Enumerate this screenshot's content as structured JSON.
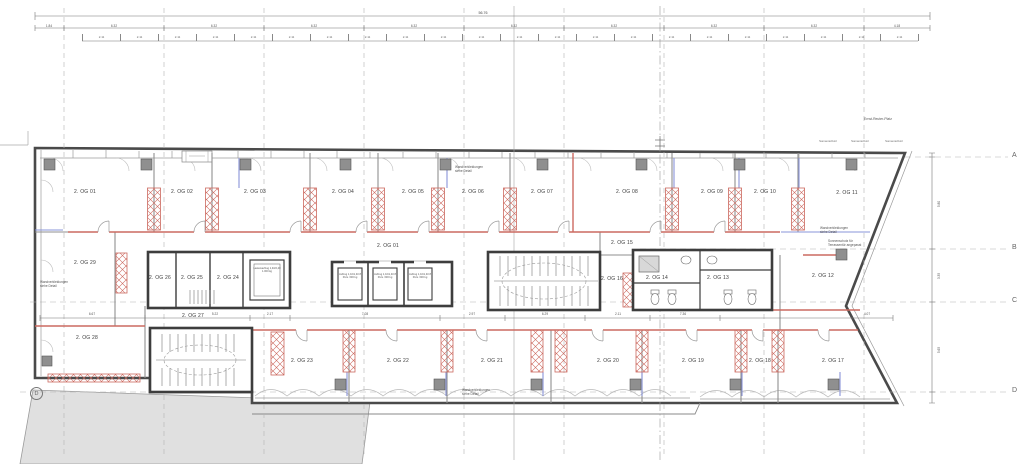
{
  "meta": {
    "drawing": "Grundriss 2. Obergeschoss",
    "floor_prefix": "2. OG"
  },
  "street_label": "Ernst-Reuter-Platz",
  "rooms": [
    {
      "label": "2. OG 01"
    },
    {
      "label": "2. OG 02"
    },
    {
      "label": "2. OG 03"
    },
    {
      "label": "2. OG 04"
    },
    {
      "label": "2. OG 05"
    },
    {
      "label": "2. OG 06"
    },
    {
      "label": "2. OG 07"
    },
    {
      "label": "2. OG 08"
    },
    {
      "label": "2. OG 09"
    },
    {
      "label": "2. OG 10"
    },
    {
      "label": "2. OG 11"
    },
    {
      "label": "2. OG 01"
    },
    {
      "label": "2. OG 15"
    },
    {
      "label": "2. OG 29"
    },
    {
      "label": "2. OG 26"
    },
    {
      "label": "2. OG 25"
    },
    {
      "label": "2. OG 24"
    },
    {
      "label": "2. OG 14"
    },
    {
      "label": "2. OG 13"
    },
    {
      "label": "2. OG 16"
    },
    {
      "label": "2. OG 12"
    },
    {
      "label": "2. OG 27"
    },
    {
      "label": "2. OG 28"
    },
    {
      "label": "2. OG 23"
    },
    {
      "label": "2. OG 22"
    },
    {
      "label": "2. OG 21"
    },
    {
      "label": "2. OG 20"
    },
    {
      "label": "2. OG 19"
    },
    {
      "label": "2. OG 18"
    },
    {
      "label": "2. OG 17"
    }
  ],
  "grid": {
    "letters": [
      "A",
      "B",
      "C",
      "D"
    ],
    "left_marker": "D"
  },
  "dimensions": {
    "total": "56.76",
    "row2": [
      "1.84",
      "6.32",
      "6.32",
      "6.32",
      "6.32",
      "6.32",
      "6.32",
      "6.32",
      "6.32",
      "4.18"
    ],
    "row3": [
      "2.11",
      "2.11",
      "2.11",
      "2.11",
      "2.11",
      "2.11",
      "2.11",
      "2.11",
      "2.11",
      "2.11",
      "2.11",
      "2.11",
      "2.11",
      "2.11",
      "2.11",
      "2.11",
      "2.11",
      "2.11",
      "2.11",
      "2.11",
      "2.11",
      "2.11"
    ],
    "corridor": [
      "6.67",
      "5.22",
      "2.17",
      "7.08",
      "2.97",
      "6.29",
      "2.11",
      "7.36",
      "4.07"
    ],
    "vertical_right": [
      "5.80",
      "3.35",
      "5.65"
    ]
  },
  "notes": {
    "cladding": "Wandverkleidungen siehe Detail",
    "sun_note": "Sonnenschutz für Terrassentür angepasst",
    "sun": "Sonnenschutz"
  },
  "elevators": {
    "passenger": "Aufzug 1,10/1,40 8 Pers. 630 kg",
    "freight": "Lastenaufzug 1,40/2,40 1.000 kg"
  },
  "colors": {
    "new_construction_red": "#cc6a60",
    "systems_blue": "#8a94d8",
    "existing_wall": "#4a4a4a",
    "neighbor_fill": "#e0e0e0"
  }
}
